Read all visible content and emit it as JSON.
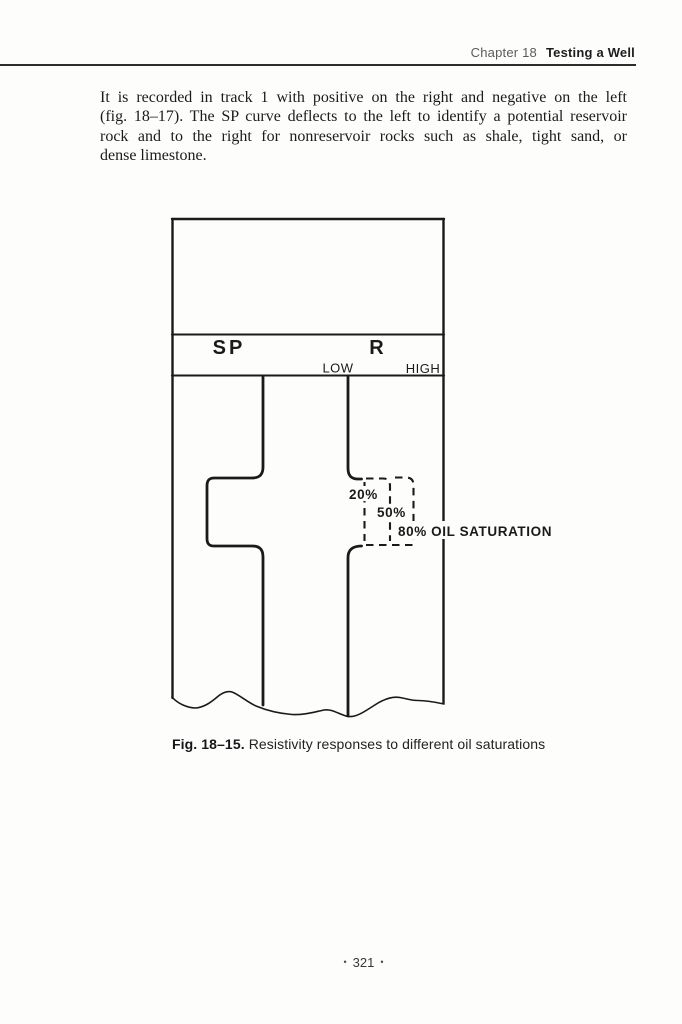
{
  "header": {
    "chapter_label": "Chapter 18",
    "section_title": "Testing a Well"
  },
  "body": {
    "lines": [
      "It is recorded in track 1 with positive on the right and negative on the left",
      "(fig. 18–17). The SP curve deflects to the left to identify a potential reservoir",
      "rock and to the right for nonreservoir rocks such as shale, tight sand, or",
      "dense limestone."
    ]
  },
  "figure": {
    "track_labels": {
      "sp": "SP",
      "resistivity": "R",
      "low": "LOW",
      "high": "HIGH"
    },
    "saturation_labels": {
      "s20": "20%",
      "s50": "50%",
      "s80": "80% OIL SATURATION"
    }
  },
  "caption": {
    "figure_ref": "Fig. 18–15.",
    "description": "Resistivity responses to different oil saturations"
  },
  "footer": {
    "bullet": "•",
    "page_number": "321"
  },
  "colors": {
    "ink": "#1a1a1a",
    "paper": "#fdfdfc",
    "chapter_gray": "#5b5b5d"
  }
}
